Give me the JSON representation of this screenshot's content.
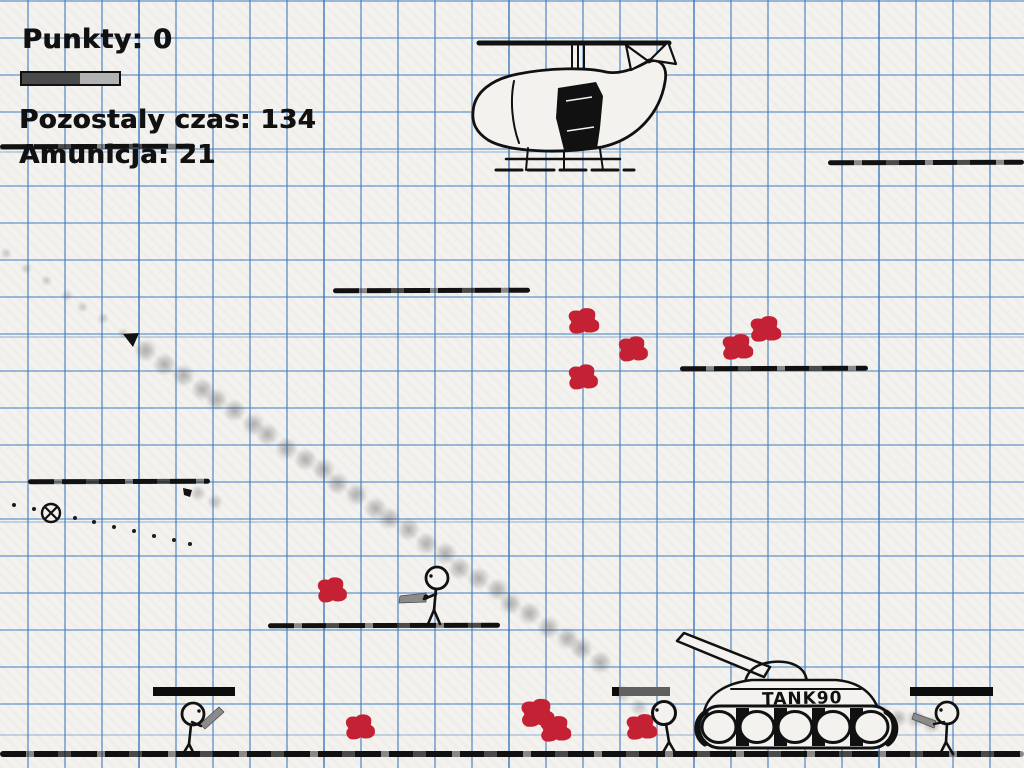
{
  "hud": {
    "points_text": "Punkty: 0",
    "time_text": "Pozostaly czas: 134",
    "ammo_text": "Amunicja: 21",
    "player_health_percent": 60
  },
  "sprites": {
    "tank_label": "TANK90",
    "helicopter": "hand-drawn-helicopter",
    "stickmen_count": 4
  },
  "colors": {
    "paper": "#f3f2ef",
    "grid_blue": "#407bbd",
    "ink": "#111111",
    "blood_red": "#c42135",
    "gun_gray": "#8b8b8b",
    "health_dark": "#4a4a4a",
    "health_light": "#b2b2b2"
  },
  "platforms": [
    [
      0,
      144,
      195
    ],
    [
      828,
      160,
      196
    ],
    [
      333,
      288,
      197
    ],
    [
      680,
      366,
      188
    ],
    [
      28,
      479,
      182
    ],
    [
      268,
      623,
      232
    ]
  ],
  "ground": [
    0,
    751,
    1024
  ],
  "splats": [
    [
      583,
      321,
      26
    ],
    [
      633,
      349,
      24
    ],
    [
      583,
      377,
      24
    ],
    [
      737,
      347,
      26
    ],
    [
      765,
      329,
      26
    ],
    [
      332,
      590,
      24
    ],
    [
      360,
      727,
      24
    ],
    [
      537,
      713,
      28
    ],
    [
      555,
      729,
      26
    ],
    [
      641,
      727,
      26
    ]
  ],
  "smoke_trails": [
    {
      "x1": 148,
      "y1": 352,
      "x2": 600,
      "y2": 662,
      "count": 27,
      "size": 10,
      "opacity": 0.45
    },
    {
      "x1": 8,
      "y1": 255,
      "x2": 122,
      "y2": 333,
      "count": 7,
      "size": 5,
      "opacity": 0.3
    },
    {
      "x1": 884,
      "y1": 714,
      "x2": 930,
      "y2": 723,
      "count": 4,
      "size": 8,
      "opacity": 0.4
    },
    {
      "x1": 200,
      "y1": 494,
      "x2": 216,
      "y2": 501,
      "count": 2,
      "size": 7,
      "opacity": 0.35
    },
    {
      "x1": 625,
      "y1": 695,
      "x2": 640,
      "y2": 706,
      "count": 2,
      "size": 8,
      "opacity": 0.3
    }
  ],
  "tracer_dots": [
    [
      14,
      505
    ],
    [
      34,
      509
    ],
    [
      75,
      518
    ],
    [
      94,
      522
    ],
    [
      114,
      527
    ],
    [
      134,
      531
    ],
    [
      154,
      536
    ],
    [
      174,
      540
    ],
    [
      190,
      544
    ]
  ],
  "enemy_health_bars": [
    {
      "x": 153,
      "y": 687,
      "w": 82,
      "fill_percent": 100
    },
    {
      "x": 612,
      "y": 687,
      "w": 58,
      "fill_percent": 12
    },
    {
      "x": 910,
      "y": 687,
      "w": 83,
      "fill_percent": 100
    }
  ]
}
